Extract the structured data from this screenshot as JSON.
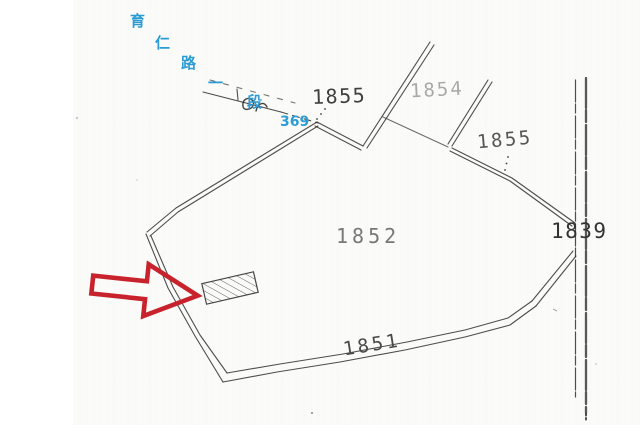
{
  "road": {
    "name_chars": [
      "育",
      "仁",
      "路",
      "一",
      "段"
    ],
    "number": "369"
  },
  "parcels": {
    "p1855_top": "1855",
    "p1854": "1854",
    "p1855_right": "1855",
    "p1852": "1852",
    "p1839": "1839",
    "p1851": "1851"
  },
  "annotations": {
    "arrow": "red outline block arrow pointing right at hatched parcel",
    "highlight": "hatched (diagonal lines) small parcel inside lot 1852"
  },
  "colors": {
    "road_name_blue": "#2c9cd4",
    "arrow_red": "#c8232c",
    "ink": "#2f2f2f",
    "paper": "#fbfbf9"
  }
}
